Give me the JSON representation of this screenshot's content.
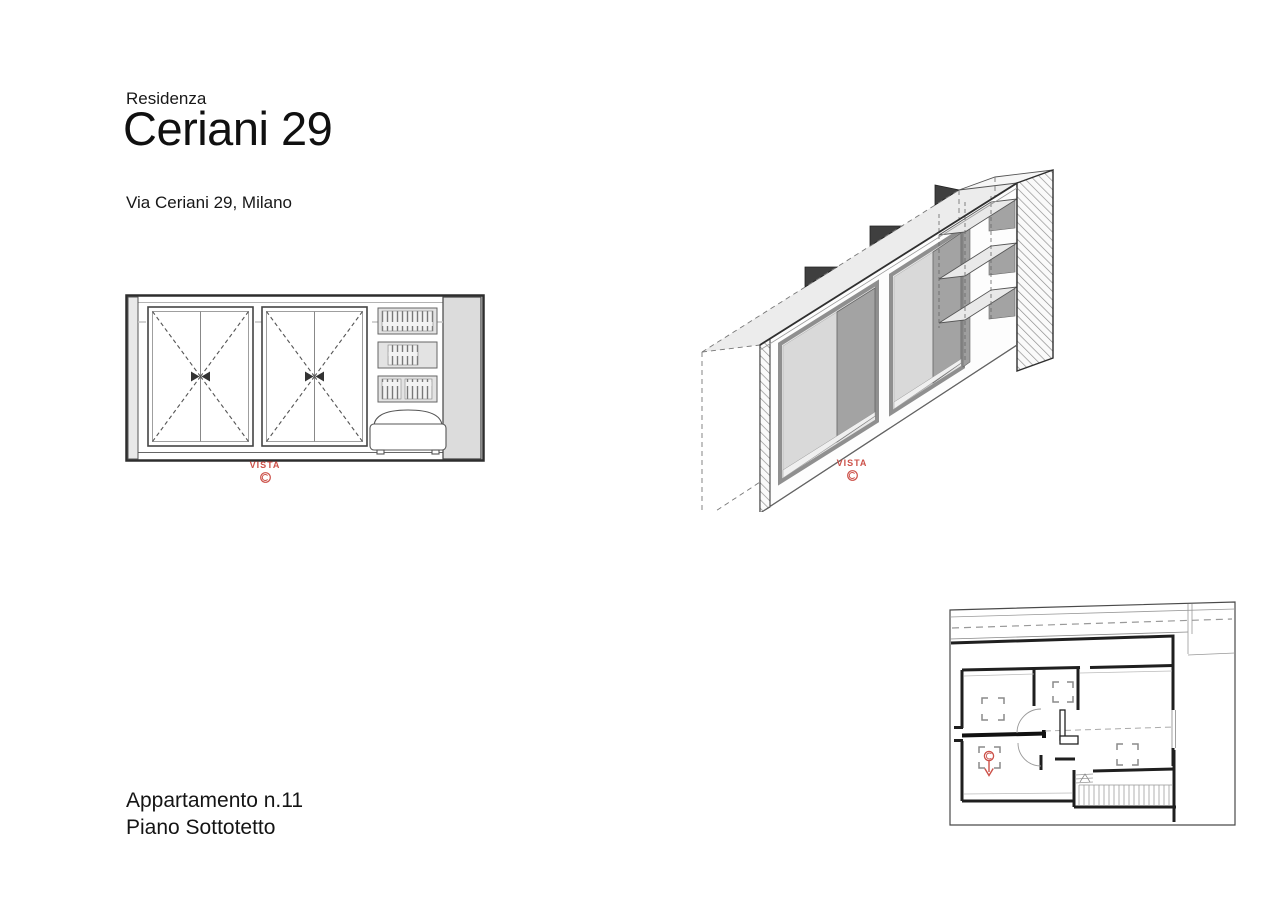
{
  "colors": {
    "accent_red": "#cc5149",
    "ink": "#1b1b1b",
    "panel_dark": "#a3a3a3",
    "panel_light": "#ececec"
  },
  "header": {
    "kicker": "Residenza",
    "title": "Ceriani 29",
    "address": "Via Ceriani 29, Milano"
  },
  "labels": {
    "vista_elevation": "VISTA",
    "vista_axon": "VISTA"
  },
  "footer": {
    "apartment": "Appartamento n.11",
    "floor": "Piano Sottotetto"
  }
}
